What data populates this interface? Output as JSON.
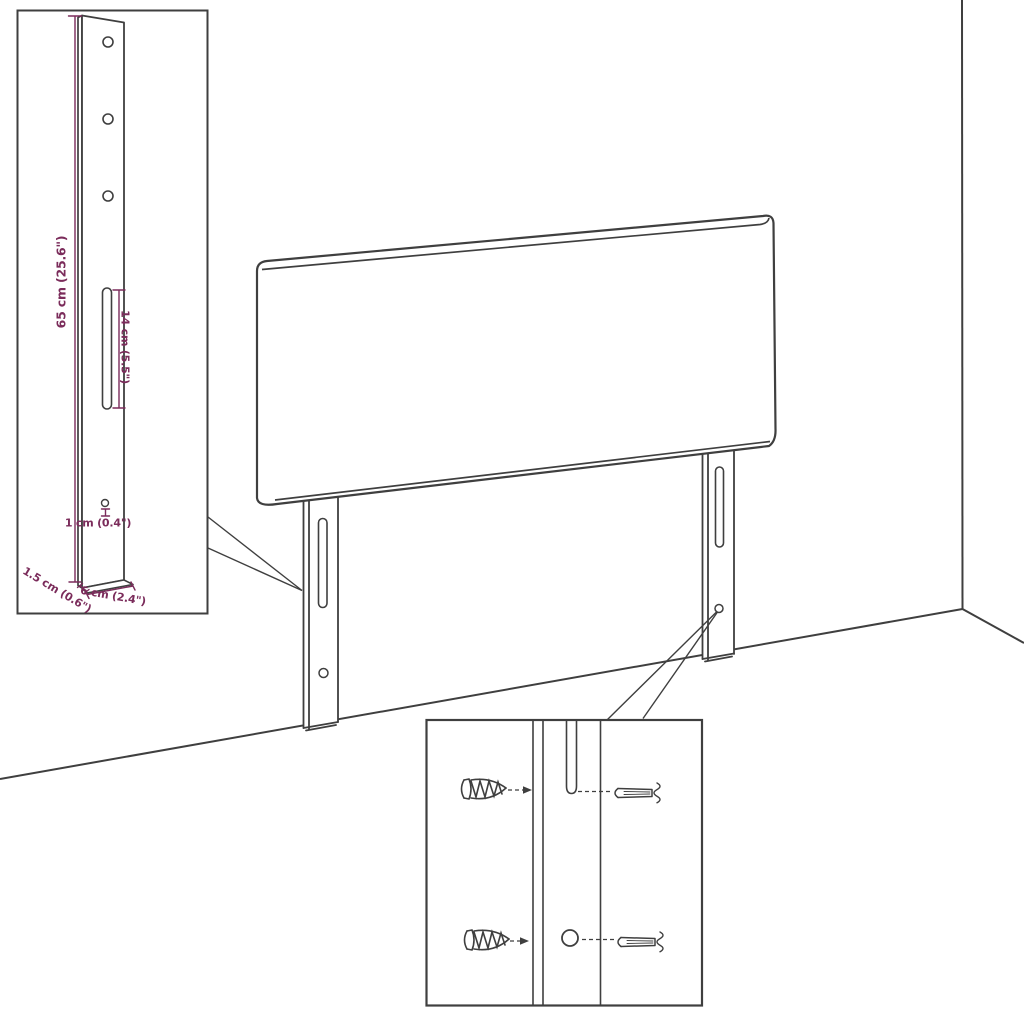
{
  "colors": {
    "line": "#3f3f3f",
    "dimension": "#7b2c5b",
    "background": "#ffffff"
  },
  "diagram": {
    "labels": {
      "height": "65 cm (25.6\")",
      "slot_length": "14 cm (5.5\")",
      "hole_diameter": "1 cm (0.4\")",
      "thickness": "1.5 cm (0.6\")",
      "width": "6 cm (2.4\")"
    }
  }
}
